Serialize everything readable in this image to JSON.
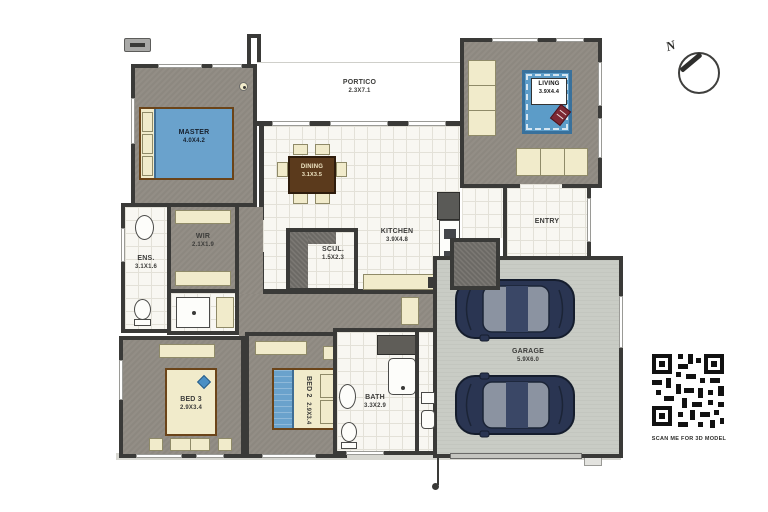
{
  "plan_title": "house-floor-plan",
  "rooms": {
    "master": {
      "name": "MASTER",
      "dims": "4.0X4.2"
    },
    "portico": {
      "name": "PORTICO",
      "dims": "2.3X7.1"
    },
    "dining": {
      "name": "DINING",
      "dims": "3.1X3.5"
    },
    "living": {
      "name": "LIVING",
      "dims": "3.9X4.4"
    },
    "entry": {
      "name": "ENTRY"
    },
    "kitchen": {
      "name": "KITCHEN",
      "dims": "3.9X4.8"
    },
    "scullery": {
      "name": "SCUL.",
      "dims": "1.5X2.3"
    },
    "wir": {
      "name": "WIR",
      "dims": "2.1X1.9"
    },
    "ensuite": {
      "name": "ENS.",
      "dims": "3.1X1.6"
    },
    "bed2": {
      "name": "BED 2",
      "dims": "2.9X3.4"
    },
    "bed3": {
      "name": "BED 3",
      "dims": "2.9X3.4"
    },
    "bath": {
      "name": "BATH",
      "dims": "3.3X2.9"
    },
    "garage": {
      "name": "GARAGE",
      "dims": "5.9X6.0"
    }
  },
  "compass": {
    "label": "N"
  },
  "qr": {
    "caption": "SCAN ME FOR 3D MODEL"
  },
  "colors": {
    "wall": "#3a3a38",
    "carpet": "#8d8880",
    "tile": "#f8f7f2",
    "concrete": "#c9ccc5",
    "furniture_cream": "#f1ebcb",
    "bed_blue": "#6aa2cc",
    "rug_blue": "#5c9cc8",
    "car_navy": "#2a3552",
    "table_brown": "#5b3a1c"
  }
}
